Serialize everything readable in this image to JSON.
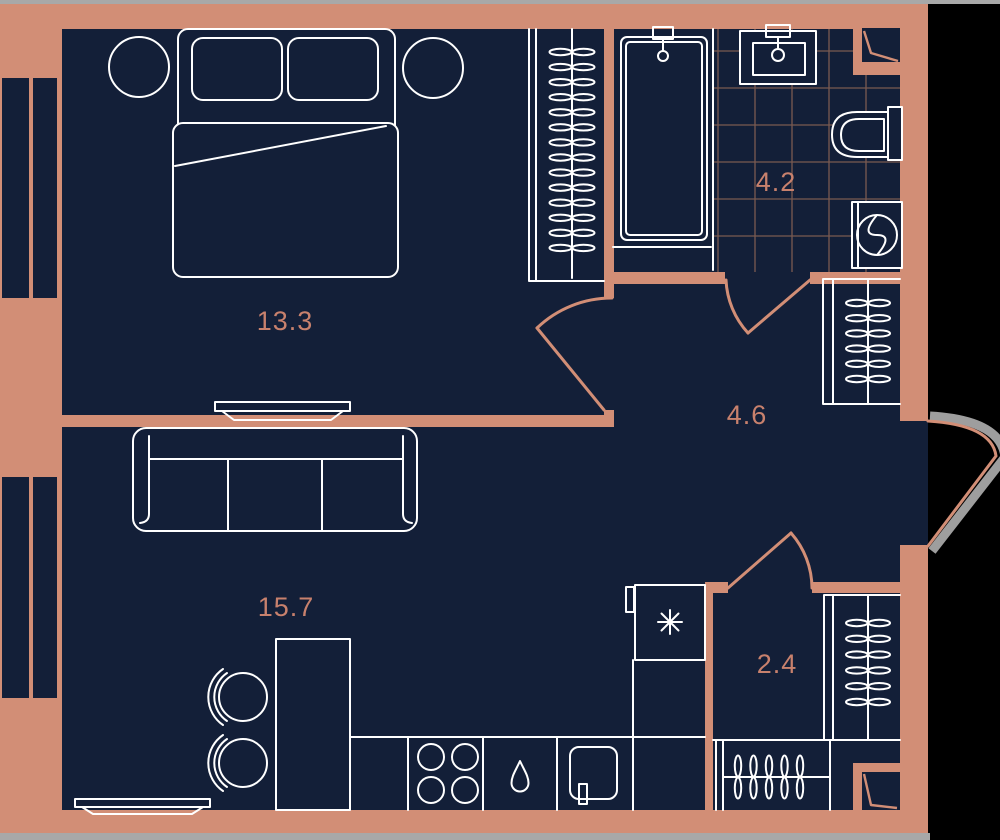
{
  "plan": {
    "colors": {
      "outside": "#000000",
      "wall": "#d28e76",
      "floor": "#131f38",
      "line": "#ffffff",
      "label": "#c8816d",
      "tile_line": "#7a5a50",
      "edge_strip": "#a8a8a8",
      "door_swing_shadow": "#9e9e9e"
    },
    "rooms": [
      {
        "id": "bedroom",
        "label": "13.3"
      },
      {
        "id": "bathroom",
        "label": "4.2"
      },
      {
        "id": "hallway",
        "label": "4.6"
      },
      {
        "id": "living-kitchen",
        "label": "15.7"
      },
      {
        "id": "wardrobe",
        "label": "2.4"
      }
    ]
  }
}
